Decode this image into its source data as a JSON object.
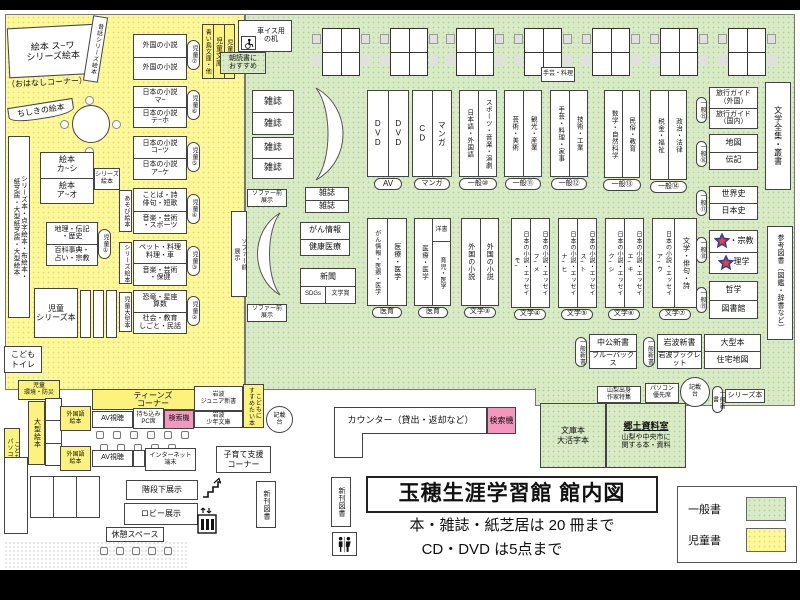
{
  "title_block": {
    "title": "玉穂生涯学習館 館内図",
    "note1": "本・雑誌・紙芝居は 20 冊まで",
    "note2": "CD・DVD は5点まで"
  },
  "legend": {
    "general": "一般書",
    "children": "児童書"
  },
  "colors": {
    "general_area": "#d9ebc6",
    "children_area": "#fdf899",
    "search_machine": "#f397be",
    "star_fill": "#e8432e",
    "star_stroke": "#2b3f9e"
  },
  "kids": {
    "ohanashi": {
      "l1": "絵本 ス~ワ",
      "l2": "シリーズ絵本",
      "l3": "（おはなしコーナー）"
    },
    "mukashi": "昔話シリーズ絵本",
    "chishiki": "ちしきの絵本",
    "left_wall": "シリーズ本・点字絵本・布絵本・\n紙芝居・大型紙芝居・大型絵本",
    "ehon": {
      "r1": "絵本\nカ~シ",
      "r2": "絵本\nア~オ",
      "side": "シリーズ\n絵本"
    },
    "shelves": [
      {
        "r1": "外国の小説",
        "r2": "外国の小説",
        "tag": "児童⑦"
      },
      {
        "r1": "日本の小説\nマ~",
        "r2": "日本の小説\nテ~ホ",
        "tag": "児童⑥"
      },
      {
        "r1": "日本の小説\nコ~ツ",
        "r2": "日本の小説\nア~ケ",
        "tag": "児童⑤"
      },
      {
        "r1": "ことば・詩\n俳句・短歌",
        "r2": "音楽・芸術\n・スポーツ",
        "tag": "児童④",
        "side": "あそび絵本"
      },
      {
        "r1": "ペット・料理\n料理・車",
        "r2": "音楽・芸術\n・保健",
        "tag": "児童③",
        "side": "シリーズ絵本"
      },
      {
        "r1": "恐竜・星座\n算数",
        "r2": "社会・教育\nしごと・民話",
        "tag": "児童②",
        "side": "児童大型本"
      },
      {
        "r1": "地理・伝記\n・歴史",
        "r2": "百科事典・\n占い・宗教",
        "tag": "児童①"
      }
    ],
    "series_box": "児童\nシリーズ本",
    "toilet": "こども\nトイレ",
    "bunko": {
      "sub": "青い鳥文庫・他",
      "main": "児童文庫",
      "tag": "児童名作"
    },
    "asadoku": "朝読書に\nおすすめ",
    "kankyo": "児童\n環境・防災",
    "ogata_ehon": "大型絵本",
    "kids_pc": "こども\nパソコン"
  },
  "general": {
    "wheelchair_desk": "車イス用\nの机",
    "magazine": "雑誌",
    "sofa_front": "ソファー前\n展示",
    "craft_note": "手芸・料理",
    "cancer": {
      "r1": "がん情報",
      "r2": "健康医療"
    },
    "news": {
      "r1": "新聞",
      "c1": "SDGs",
      "c2": "文学賞"
    },
    "row1": [
      {
        "c1": "DVD",
        "c2": "DVD",
        "tag": "AV"
      },
      {
        "c1": "CD",
        "c2": "マンガ",
        "tag": "マンガ"
      },
      {
        "c1": "日本語・外国語",
        "c2": "スポーツ・音楽・演劇",
        "tag": "一般⑩"
      },
      {
        "c1": "芸術・美術",
        "c2": "観光・産業",
        "tag": "一般⑪"
      },
      {
        "c1": "手芸・料理・家事",
        "c2": "技術・工業",
        "tag": "一般⑫"
      },
      {
        "c1": "数学・自然科学",
        "c2": "民俗・教育",
        "tag": "一般⑬"
      },
      {
        "c1": "税金・福祉",
        "c2": "政治・法律",
        "tag": "一般⑭"
      }
    ],
    "row2": [
      {
        "c1": "がん情報・医療・医学",
        "c2": "医療・医学",
        "tag": "医育"
      },
      {
        "c1": "医療・医学",
        "c2_top": "洋書",
        "c2_bottom": "育児・医学",
        "tag": "医育"
      },
      {
        "c1": "外国の小説",
        "c2": "外国の小説",
        "tag": "文学③"
      },
      {
        "c1": "日本の小説・エッセイ\nモ~",
        "c2": "日本の小説・エッセイ\nフ~メ",
        "tag": "文学④"
      },
      {
        "c1": "日本の小説・エッセイ\nナ~ヒ",
        "c2": "日本の小説・エッセイ\nス~ト",
        "tag": "文学⑤"
      },
      {
        "c1": "日本の小説・エッセイ\nク~シ",
        "c2": "日本の小説・エッセイ\nエ~キ",
        "tag": "文学⑥"
      },
      {
        "c1": "日本の小説・エッセイ\nア~ウ",
        "c2": "文学・俳句・詩",
        "tag": "文学⑦"
      }
    ],
    "right_stack": [
      {
        "r1": "旅行ガイド\n（外国）",
        "r2": "旅行ガイド\n（国内）",
        "tag": "一般⑮"
      },
      {
        "r1": "地図",
        "r2": "伝記",
        "tag": "一般⑯"
      },
      {
        "r1": "世界史",
        "r2": "日本史",
        "tag": "一般⑰"
      },
      {
        "r1": "・宗教",
        "r2": "理学",
        "tag": "一般⑱"
      },
      {
        "r1": "哲学",
        "r2": "図書館",
        "tag": "一般⑲"
      }
    ],
    "wall_bungaku": "文学全集・叢書",
    "wall_sanko": "参考図書（図鑑・辞書など）",
    "shinsho": [
      {
        "r1": "中公新書",
        "r2": "ブルーバックス",
        "tag": "一般新書"
      },
      {
        "r1": "岩波新書",
        "r2": "岩波ブックレット",
        "tag": "一般新書"
      },
      {
        "r1": "大型本",
        "r2": "住宅地図"
      }
    ],
    "yamanashi": "山梨出身\n作家特集",
    "pc_seat": "パソコン\n優先席",
    "kisaidai": "記載\n台",
    "series_label": "シリーズ本",
    "shinsho_tag": "一般新書",
    "kyodo": {
      "bunko": "文庫本\n大活字本",
      "title": "郷土資料室",
      "desc": "山梨や中央市に\n関する本・資料"
    }
  },
  "counter": {
    "label": "カウンター（貸出・返却など）",
    "search": "検索機"
  },
  "teens": {
    "header": "ティーンズ\nコーナー",
    "foreign_ehon": "外国語\n絵本",
    "av": "AV視聴",
    "byopc": "持ち込み\nPC席",
    "search": "検索機",
    "internet": "インターネット\n端末",
    "iwanami_jr": "岩波\nジュニア新書",
    "iwanami_shonen": "岩波\n少年文庫",
    "susume": "こどもに\nすすめたい本",
    "kosodate": "子育て支援\nコーナー",
    "kaidan": "階段下展示",
    "lobby": "ロビー展示",
    "rest": "休憩スペース",
    "shinkan": "新刊図書"
  }
}
